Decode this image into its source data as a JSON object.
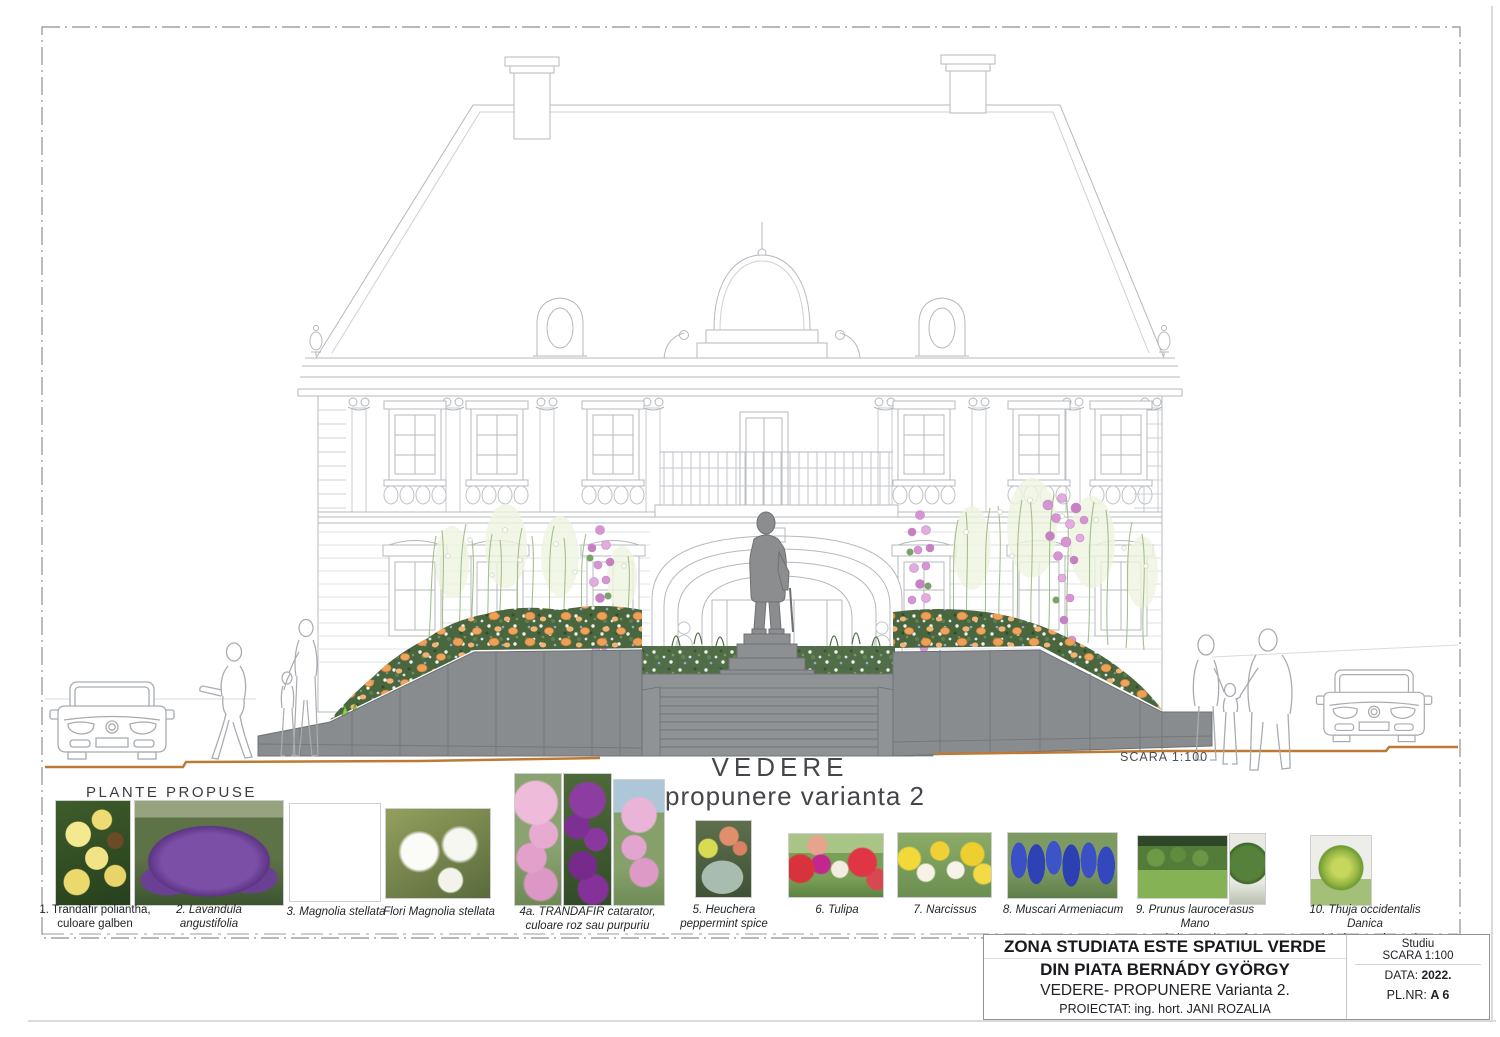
{
  "page": {
    "view_title": "VEDERE",
    "view_subtitle": "propunere varianta 2",
    "scale_note": "SCARA  1:100",
    "plants_heading": "PLANTE  PROPUSE"
  },
  "plants": [
    {
      "label": "1. Trandafir poliantha, culoare galben"
    },
    {
      "label": "2. Lavandula angustifolia"
    },
    {
      "label": "3. Magnolia stellata"
    },
    {
      "label": "Flori Magnolia stellata"
    },
    {
      "label": "4a. TRANDAFIR catarator, culoare roz sau purpuriu"
    },
    {
      "label": "5. Heuchera peppermint spice"
    },
    {
      "label": "6. Tulipa"
    },
    {
      "label": "7. Narcissus"
    },
    {
      "label": "8. Muscari Armeniacum"
    },
    {
      "label": "9. Prunus laurocerasus Mano",
      "label2": "- gard viu vesnic verde"
    },
    {
      "label": "10. Thuja occidentalis Danica",
      "label2": "- globular,vesnic verde"
    }
  ],
  "titleblock": {
    "line1": "ZONA STUDIATA ESTE SPATIUL VERDE",
    "line2": "DIN PIATA BERNÁDY GYÖRGY",
    "line3": "VEDERE- PROPUNERE  Varianta 2.",
    "line4": "PROIECTAT: ing. hort. JANI ROZALIA",
    "study_type": "Studiu",
    "scale": "SCARA  1:100",
    "date_label": "DATA:",
    "date_value": "2022.",
    "plan_number_label": "PL.NR:",
    "plan_number_value": "A 6"
  },
  "colors": {
    "line_gray": "#b4b8be",
    "stone_gray": "#8f9294",
    "ground_line_orange": "#bd7a35",
    "flower_orange": "#f0a55e",
    "flower_pink": "#d893d4",
    "grass_bright": "#8ed04e"
  }
}
